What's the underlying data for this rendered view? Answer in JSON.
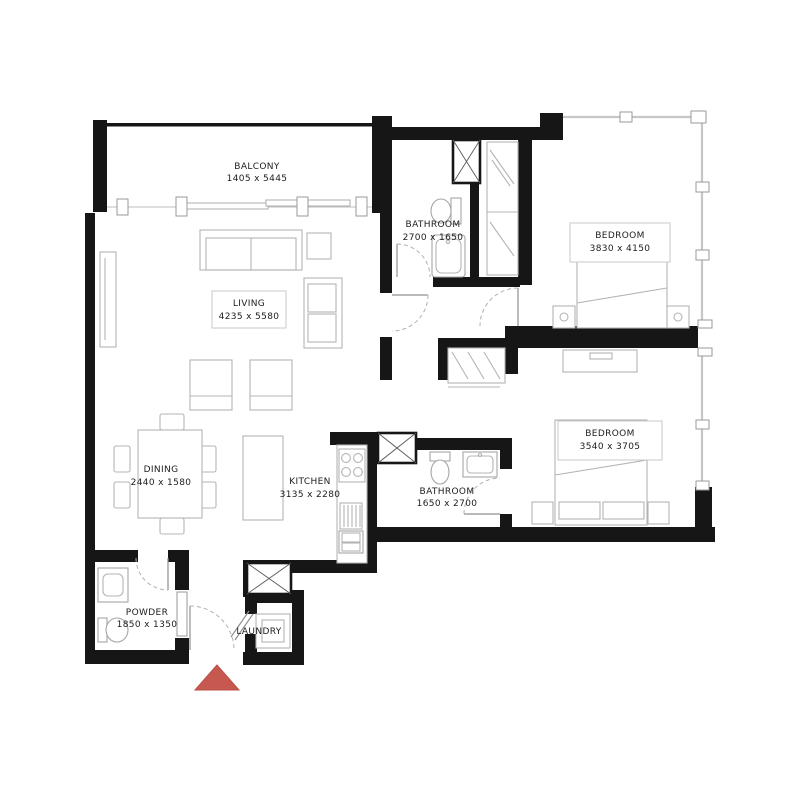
{
  "plan": {
    "rooms": {
      "balcony": {
        "name": "BALCONY",
        "dims": "1405 x 5445"
      },
      "living": {
        "name": "LIVING",
        "dims": "4235 x 5580"
      },
      "dining": {
        "name": "DINING",
        "dims": "2440 x 1580"
      },
      "kitchen": {
        "name": "KITCHEN",
        "dims": "3135 x 2280"
      },
      "bathroom1": {
        "name": "BATHROOM",
        "dims": "2700 x 1650"
      },
      "bathroom2": {
        "name": "BATHROOM",
        "dims": "1650 x 2700"
      },
      "bedroom1": {
        "name": "BEDROOM",
        "dims": "3830 x 4150"
      },
      "bedroom2": {
        "name": "BEDROOM",
        "dims": "3540 x 3705"
      },
      "powder": {
        "name": "POWDER",
        "dims": "1850 x 1350"
      },
      "laundry": {
        "name": "LAUNDRY",
        "dims": ""
      }
    },
    "colors": {
      "walls": "#161616",
      "furniture": "#b4b4b4",
      "entrance_marker": "#c7584f"
    }
  }
}
